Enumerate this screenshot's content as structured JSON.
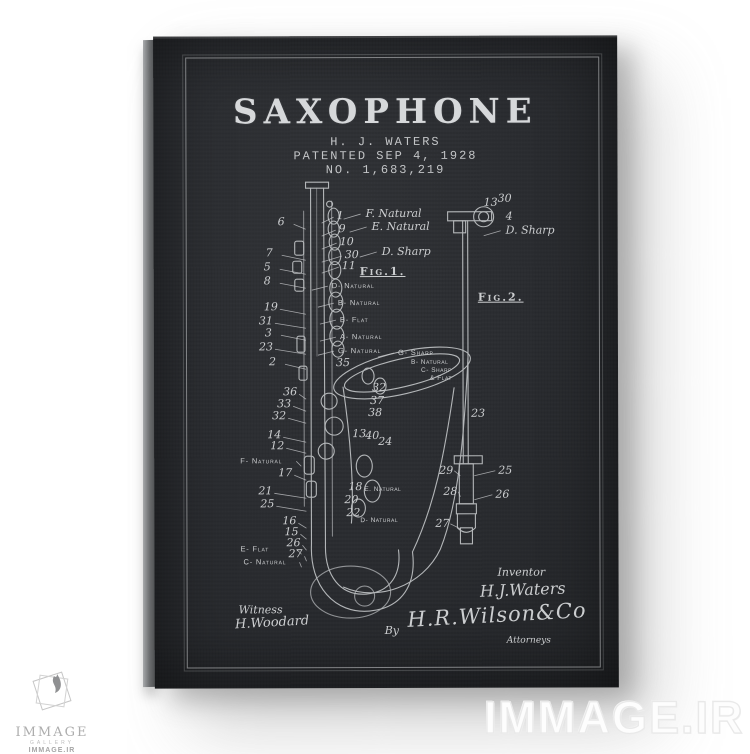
{
  "patent": {
    "title": "SAXOPHONE",
    "inventor_line": "H. J. WATERS",
    "patented_line": "PATENTED SEP 4, 1928",
    "number_line": "NO. 1,683,219"
  },
  "drawing": {
    "callouts": [
      {
        "t": "6",
        "x": 124,
        "y": 179,
        "k": "nl"
      },
      {
        "t": "7",
        "x": 112,
        "y": 210,
        "k": "nl"
      },
      {
        "t": "5",
        "x": 110,
        "y": 224,
        "k": "nl"
      },
      {
        "t": "8",
        "x": 110,
        "y": 238,
        "k": "nl"
      },
      {
        "t": "19",
        "x": 110,
        "y": 264,
        "k": "nl"
      },
      {
        "t": "31",
        "x": 105,
        "y": 278,
        "k": "nl"
      },
      {
        "t": "3",
        "x": 111,
        "y": 290,
        "k": "nl"
      },
      {
        "t": "23",
        "x": 105,
        "y": 304,
        "k": "nl"
      },
      {
        "t": "2",
        "x": 115,
        "y": 319,
        "k": "nl"
      },
      {
        "t": "36",
        "x": 129,
        "y": 349,
        "k": "nl"
      },
      {
        "t": "33",
        "x": 123,
        "y": 361,
        "k": "nl"
      },
      {
        "t": "32",
        "x": 118,
        "y": 373,
        "k": "nl"
      },
      {
        "t": "14",
        "x": 113,
        "y": 392,
        "k": "nl"
      },
      {
        "t": "12",
        "x": 116,
        "y": 403,
        "k": "nl"
      },
      {
        "t": "F- Natural",
        "x": 86,
        "y": 420,
        "k": "ll"
      },
      {
        "t": "17",
        "x": 124,
        "y": 430,
        "k": "nl"
      },
      {
        "t": "21",
        "x": 104,
        "y": 448,
        "k": "nl"
      },
      {
        "t": "25",
        "x": 106,
        "y": 461,
        "k": "nl"
      },
      {
        "t": "16",
        "x": 128,
        "y": 478,
        "k": "nl"
      },
      {
        "t": "15",
        "x": 130,
        "y": 489,
        "k": "nl"
      },
      {
        "t": "26",
        "x": 132,
        "y": 500,
        "k": "nl"
      },
      {
        "t": "27",
        "x": 134,
        "y": 511,
        "k": "nl"
      },
      {
        "t": "E- Flat",
        "x": 86,
        "y": 508,
        "k": "ll"
      },
      {
        "t": "C- Natural",
        "x": 89,
        "y": 521,
        "k": "ll"
      },
      {
        "t": "1",
        "x": 183,
        "y": 173,
        "k": "nr"
      },
      {
        "t": "F. Natural",
        "x": 212,
        "y": 171,
        "k": "lr-i"
      },
      {
        "t": "9",
        "x": 185,
        "y": 186,
        "k": "nr"
      },
      {
        "t": "E. Natural",
        "x": 218,
        "y": 184,
        "k": "lr-i"
      },
      {
        "t": "10",
        "x": 186,
        "y": 199,
        "k": "nr"
      },
      {
        "t": "30",
        "x": 191,
        "y": 212,
        "k": "nr"
      },
      {
        "t": "D. Sharp",
        "x": 228,
        "y": 209,
        "k": "lr-i"
      },
      {
        "t": "11",
        "x": 188,
        "y": 223,
        "k": "nr"
      },
      {
        "t": "Fig.1.",
        "x": 206,
        "y": 229,
        "k": "fig"
      },
      {
        "t": "D- Natural",
        "x": 178,
        "y": 245,
        "k": "lr"
      },
      {
        "t": "B- Natural",
        "x": 184,
        "y": 262,
        "k": "lr"
      },
      {
        "t": "B- Flat",
        "x": 186,
        "y": 279,
        "k": "lr"
      },
      {
        "t": "A- Natural",
        "x": 186,
        "y": 296,
        "k": "lr"
      },
      {
        "t": "G- Natural",
        "x": 184,
        "y": 310,
        "k": "lr"
      },
      {
        "t": "G- Sharp",
        "x": 244,
        "y": 312,
        "k": "lr"
      },
      {
        "t": "35",
        "x": 182,
        "y": 320,
        "k": "n"
      },
      {
        "t": "B- Natural",
        "x": 257,
        "y": 323,
        "k": "sm"
      },
      {
        "t": "C- Sharp",
        "x": 267,
        "y": 331,
        "k": "sm"
      },
      {
        "t": "& Flat",
        "x": 276,
        "y": 339,
        "k": "sm"
      },
      {
        "t": "32",
        "x": 218,
        "y": 345,
        "k": "n"
      },
      {
        "t": "37",
        "x": 216,
        "y": 358,
        "k": "n"
      },
      {
        "t": "38",
        "x": 214,
        "y": 370,
        "k": "n"
      },
      {
        "t": "13",
        "x": 198,
        "y": 391,
        "k": "n"
      },
      {
        "t": "40",
        "x": 211,
        "y": 393,
        "k": "n"
      },
      {
        "t": "24",
        "x": 224,
        "y": 399,
        "k": "n"
      },
      {
        "t": "18",
        "x": 194,
        "y": 444,
        "k": "n"
      },
      {
        "t": "20",
        "x": 190,
        "y": 457,
        "k": "n"
      },
      {
        "t": "E. Natural",
        "x": 210,
        "y": 450,
        "k": "sm"
      },
      {
        "t": "22",
        "x": 192,
        "y": 470,
        "k": "n"
      },
      {
        "t": "D- Natural",
        "x": 206,
        "y": 481,
        "k": "sm"
      },
      {
        "t": "13",
        "x": 330,
        "y": 160,
        "k": "n"
      },
      {
        "t": "30",
        "x": 344,
        "y": 156,
        "k": "n"
      },
      {
        "t": "4",
        "x": 352,
        "y": 174,
        "k": "n"
      },
      {
        "t": "D. Sharp",
        "x": 352,
        "y": 188,
        "k": "lr-i"
      },
      {
        "t": "Fig.2.",
        "x": 324,
        "y": 255,
        "k": "fig"
      },
      {
        "t": "23",
        "x": 317,
        "y": 371,
        "k": "n"
      },
      {
        "t": "29",
        "x": 285,
        "y": 428,
        "k": "f2l"
      },
      {
        "t": "25",
        "x": 344,
        "y": 428,
        "k": "f2r"
      },
      {
        "t": "28",
        "x": 289,
        "y": 449,
        "k": "f2l"
      },
      {
        "t": "26",
        "x": 341,
        "y": 452,
        "k": "f2r"
      },
      {
        "t": "27",
        "x": 281,
        "y": 481,
        "k": "f2l"
      },
      {
        "t": "Witness",
        "x": 84,
        "y": 567,
        "k": "sig-sm"
      },
      {
        "t": "H.Woodard",
        "x": 80,
        "y": 581,
        "k": "sig-md"
      },
      {
        "t": "Inventor",
        "x": 343,
        "y": 530,
        "k": "sig-sm"
      },
      {
        "t": "H.J.Waters",
        "x": 325,
        "y": 546,
        "k": "sig-lg"
      },
      {
        "t": "By",
        "x": 230,
        "y": 588,
        "k": "sig-sm"
      },
      {
        "t": "H.R.Wilson&Co",
        "x": 252,
        "y": 572,
        "k": "sig-xl"
      },
      {
        "t": "Attorneys",
        "x": 352,
        "y": 600,
        "k": "sig-xs"
      }
    ]
  },
  "watermark": {
    "text": "IMMAGE.IR"
  },
  "logo": {
    "name": "IMMAGE",
    "sub": "GALLERY",
    "site": "IMMAGE.IR"
  },
  "colors": {
    "canvas": "#2a2c30",
    "ink": "#ccced0",
    "page_bg": "#ffffff"
  }
}
